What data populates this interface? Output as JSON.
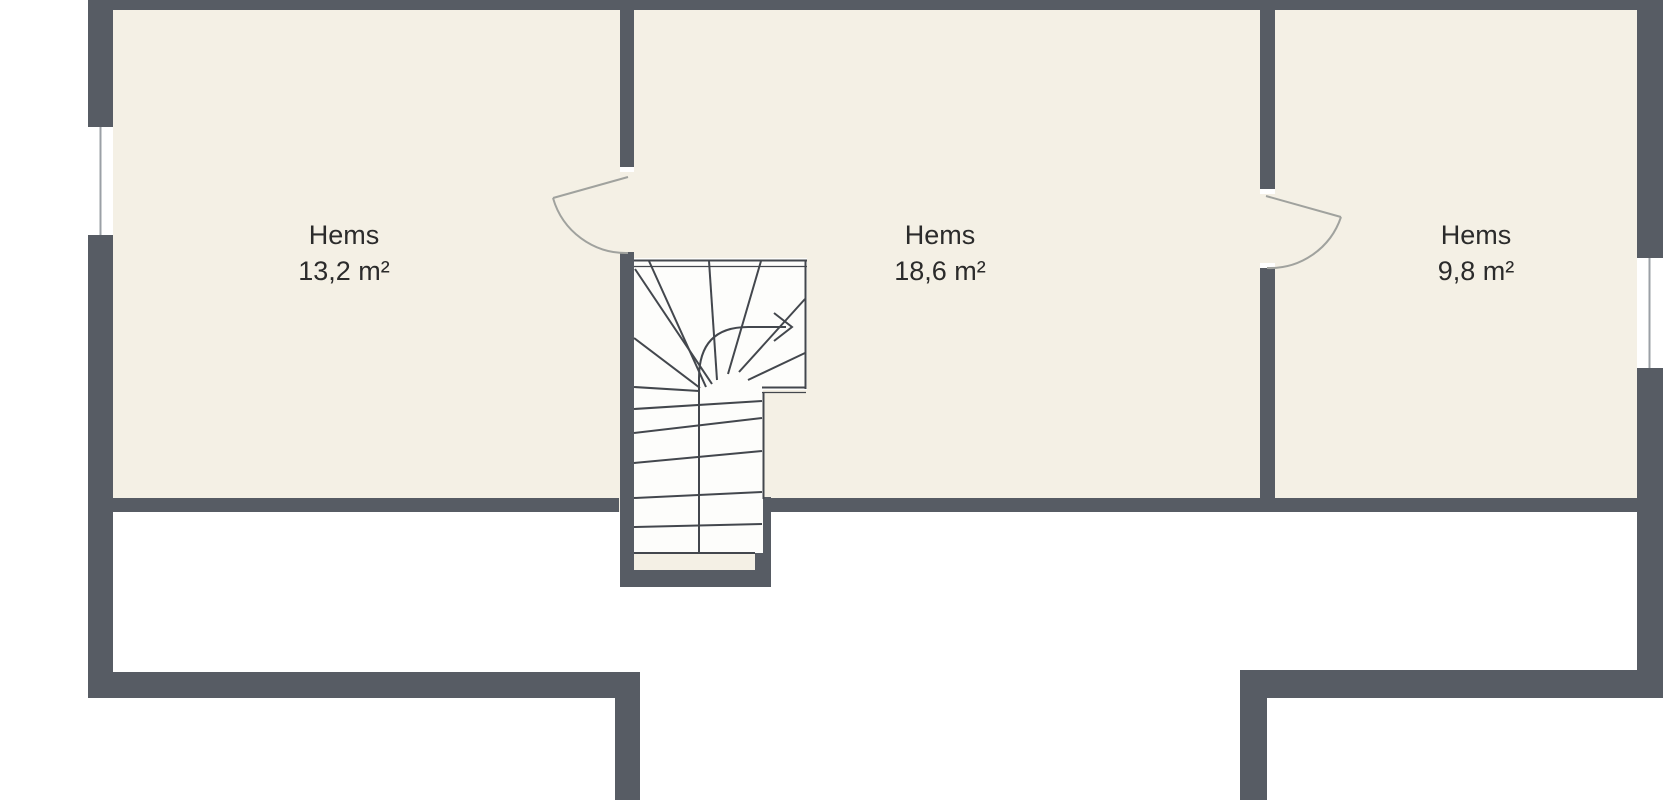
{
  "rooms": [
    {
      "name": "Hems",
      "area": "13,2 m²"
    },
    {
      "name": "Hems",
      "area": "18,6 m²"
    },
    {
      "name": "Hems",
      "area": "9,8 m²"
    }
  ],
  "colors": {
    "background": "#ffffff",
    "floor": "#f4f0e5",
    "wall": "#575c64",
    "stair_fill": "#fdfdfb",
    "stair_line": "#43474d",
    "door_line": "#a0a29e",
    "window_line": "#9ba0a6",
    "label_text": "#2b2b2b"
  }
}
